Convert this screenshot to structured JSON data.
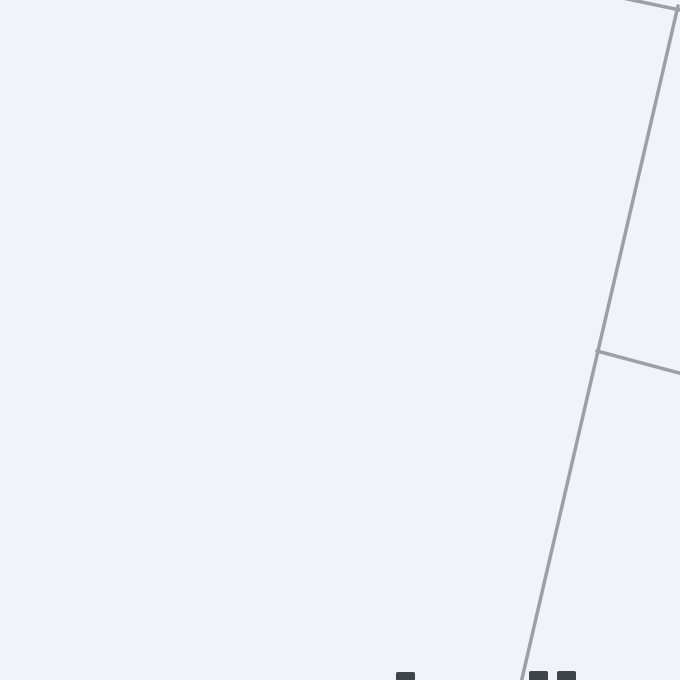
{
  "map": {
    "background_color": "#f0f4f9",
    "road_color": "#9aa0a6",
    "road_width": 3.5,
    "label_color": "#3f444a",
    "roads": [
      {
        "name": "main-diagonal-road",
        "points": [
          [
            678,
            6
          ],
          [
            521,
            683
          ]
        ]
      },
      {
        "name": "top-right-corner-road",
        "points": [
          [
            613,
            -4
          ],
          [
            680,
            10
          ]
        ]
      },
      {
        "name": "right-branch-road",
        "points": [
          [
            597,
            351
          ],
          [
            683,
            374
          ]
        ]
      }
    ],
    "label_fragments": [
      {
        "x": 396,
        "y": 672,
        "w": 19,
        "h": 8
      },
      {
        "x": 529,
        "y": 671,
        "w": 19,
        "h": 9
      },
      {
        "x": 557,
        "y": 671,
        "w": 19,
        "h": 9
      }
    ]
  }
}
